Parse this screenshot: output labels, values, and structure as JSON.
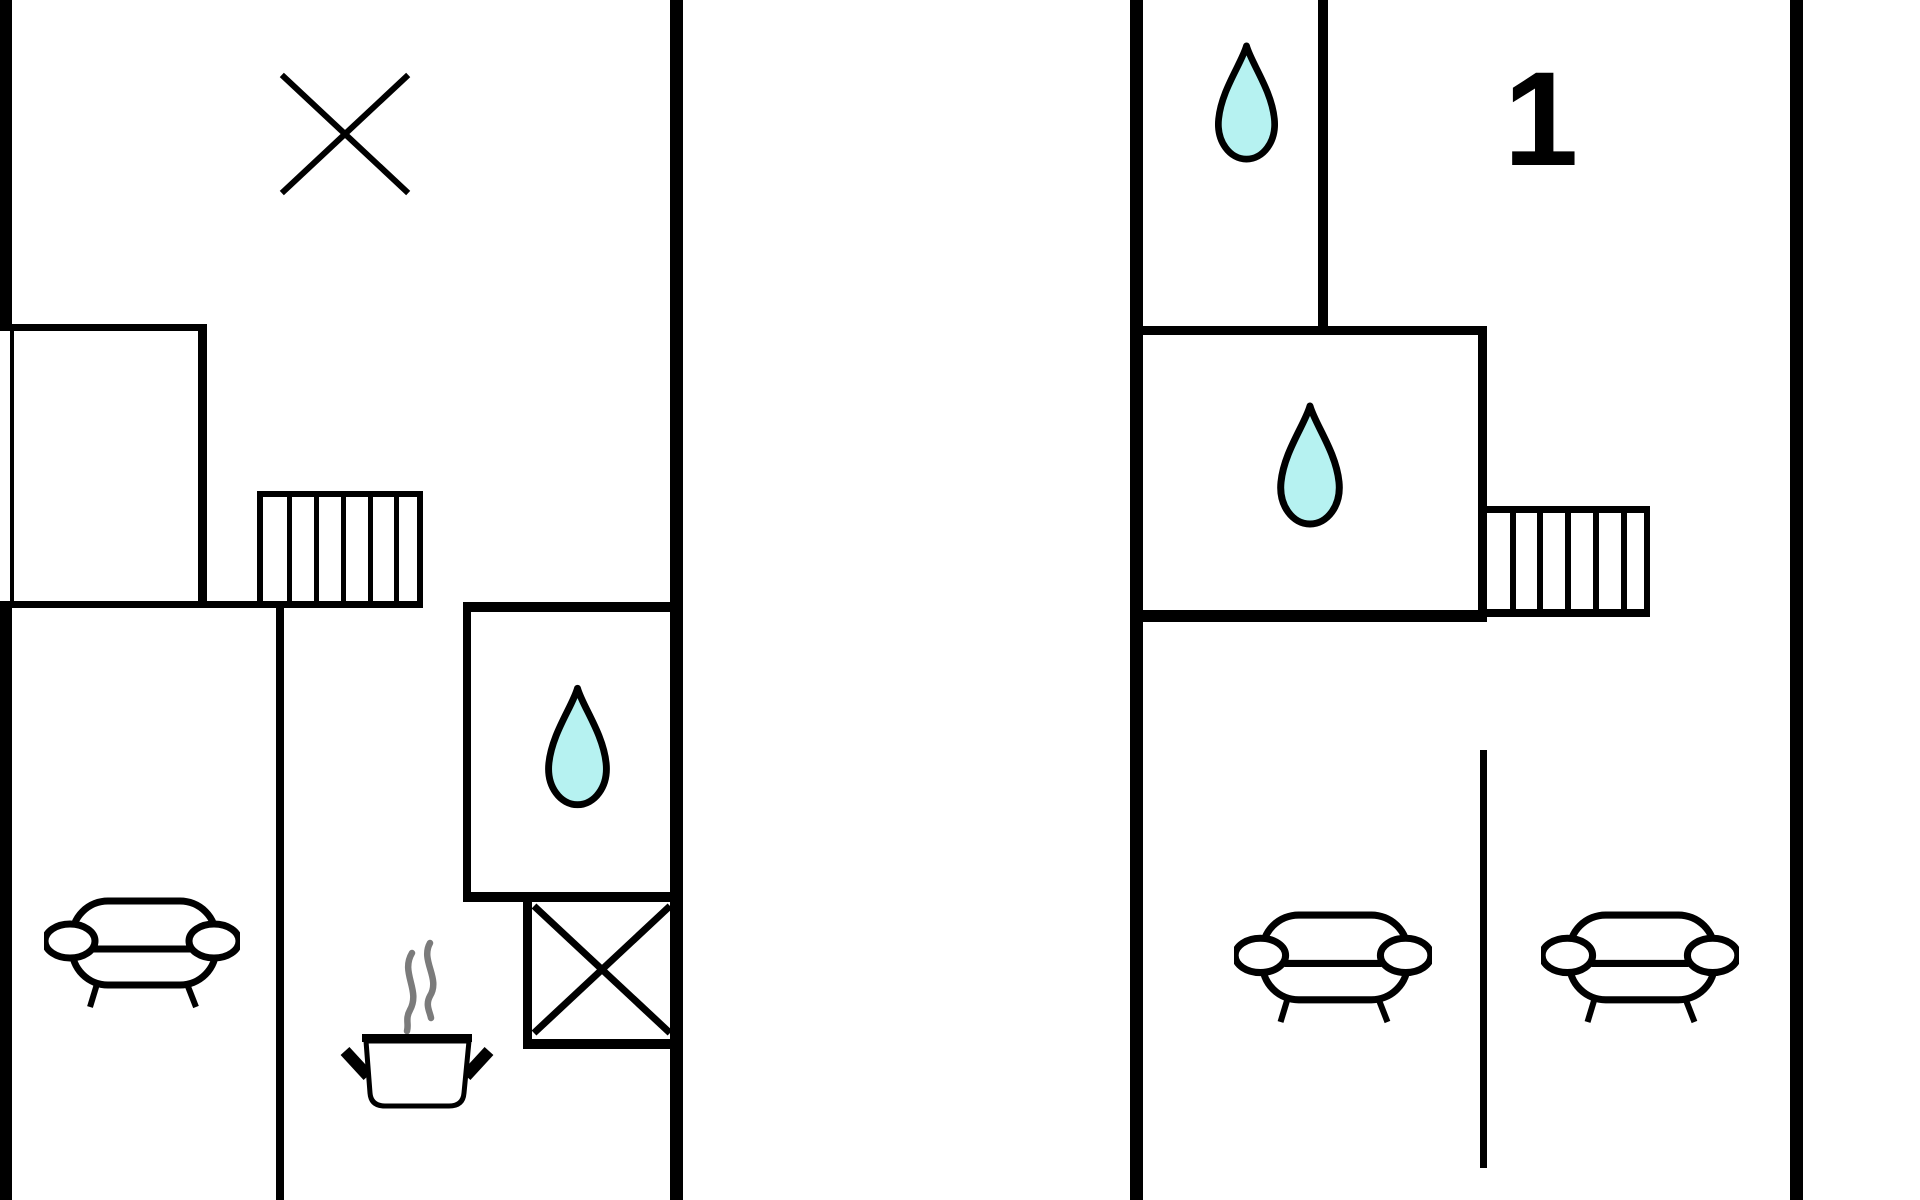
{
  "diagram": {
    "type": "floor-plan",
    "unit_label": "1",
    "colors": {
      "wall": "#000000",
      "background": "#ffffff",
      "water_drop_fill": "#b6f2f1",
      "water_drop_stroke": "#000000",
      "steam": "#7b7b7b",
      "label": "#000000"
    },
    "left_plan": {
      "features": [
        {
          "name": "window-x-mark"
        },
        {
          "name": "closet-room"
        },
        {
          "name": "stairs",
          "treads": 6
        },
        {
          "name": "bathroom",
          "icon": "water-drop"
        },
        {
          "name": "sofa"
        },
        {
          "name": "kitchen",
          "icon": "cooking-pot",
          "steam": true
        },
        {
          "name": "crossed-box"
        }
      ],
      "water_drop_count": 1,
      "sofa_count": 1
    },
    "right_plan": {
      "label": "1",
      "features": [
        {
          "name": "toilet-room",
          "icon": "water-drop"
        },
        {
          "name": "bathroom",
          "icon": "water-drop"
        },
        {
          "name": "stairs",
          "treads": 6
        },
        {
          "name": "room-divider"
        },
        {
          "name": "sofa"
        },
        {
          "name": "sofa"
        }
      ],
      "water_drop_count": 2,
      "sofa_count": 2
    }
  }
}
